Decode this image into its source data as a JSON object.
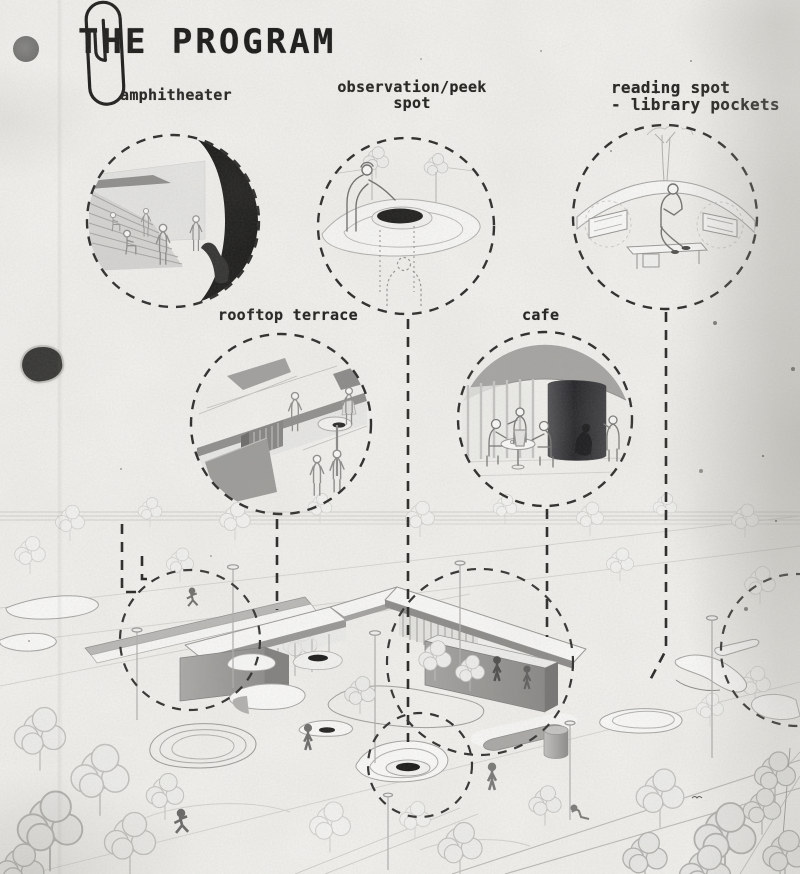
{
  "title": "THE PROGRAM",
  "vignettes": [
    {
      "id": "amphitheater",
      "label": "amphitheater"
    },
    {
      "id": "observation-peek-spot",
      "label": "observation/peek\nspot"
    },
    {
      "id": "reading-spot",
      "label": "reading spot\n- library pockets"
    },
    {
      "id": "rooftop-terrace",
      "label": "rooftop terrace"
    },
    {
      "id": "cafe",
      "label": "cafe"
    }
  ],
  "colors": {
    "paper": "#f4f3f0",
    "ink": "#161615",
    "dashed_line": "#242423",
    "dark_fill": "#181817",
    "mid_gray": "#989795",
    "light_line": "#c9c8c5",
    "silhouette": "#6b6b69",
    "hole_punch": "#707070"
  }
}
